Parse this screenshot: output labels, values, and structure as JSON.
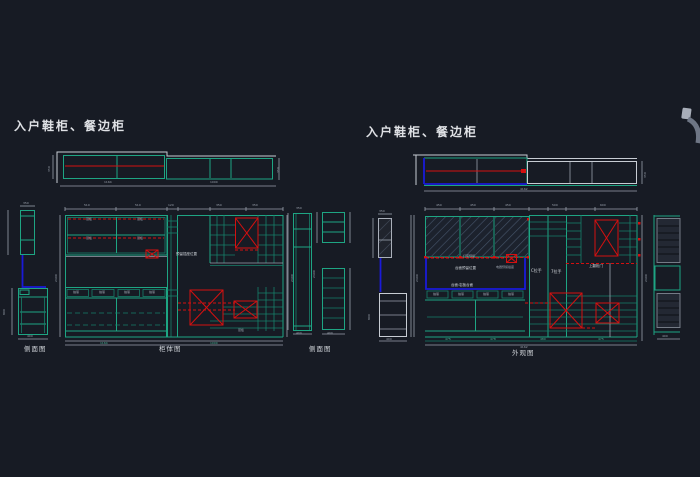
{
  "app": {
    "background": "#171b24"
  },
  "colors": {
    "teal": "#1ea583",
    "red": "#d41010",
    "blue": "#1a1ad8",
    "dim_gray": "#9aa1ac",
    "bright": "#c7ccd3",
    "text": "#dfe1e5"
  },
  "titles": {
    "left": "入户鞋柜、餐边柜",
    "right": "入户鞋柜、餐边柜"
  },
  "captions": {
    "side": "侧面图",
    "main_left": "柜体图",
    "side2": "侧面图",
    "main_right": "外观图"
  },
  "labels": {
    "shelf": "层板",
    "drawer": "抽屉",
    "socket_note": "预留插座位置",
    "layer": "层板",
    "handle_c": "C拉手",
    "handle_7": "7拉手",
    "flip_door": "上翻柜门",
    "light_strip": "灯带预留",
    "counter_mid": "台面预留位置",
    "counter_material": "台面:岩板台面",
    "appliance_socket": "电器预留插座"
  },
  "dims": {
    "d120": "120",
    "d350": "350",
    "d400": "400",
    "d450": "450",
    "d475": "475",
    "d478": "478",
    "d480": "480",
    "d500": "500",
    "d510": "510",
    "d600": "600",
    "d800": "800",
    "d1000": "1000",
    "d1164": "1164",
    "d2164": "2164",
    "d2400": "2400",
    "d4162": "4162"
  }
}
